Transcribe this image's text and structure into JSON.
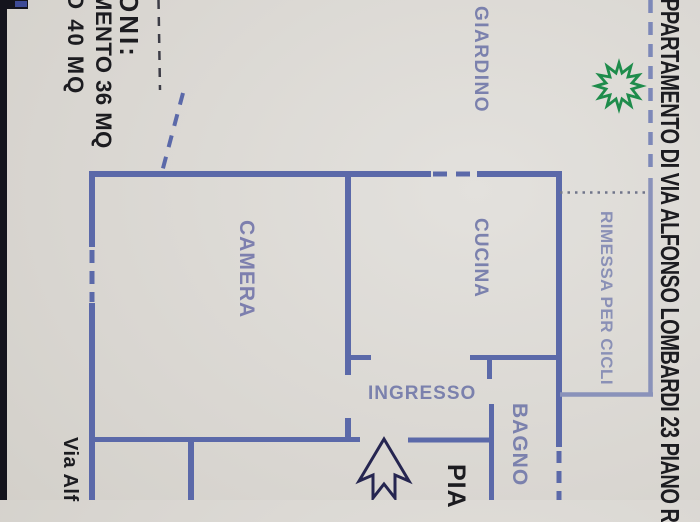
{
  "title_right": "PPARTAMENTO DI VIA ALFONSO LOMBARDI 23 PIANO R",
  "notes_top_left": {
    "line1": "ONI:",
    "line2": "MENTO 36 MQ",
    "line3": "O 40 MQ"
  },
  "street_label": "Via Alf",
  "plan_word": "PIA",
  "rooms": {
    "giardino": "GIARDINO",
    "camera": "CAMERA",
    "cucina": "CUCINA",
    "ingresso": "INGRESSO",
    "bagno": "BAGNO",
    "rimessa": "RIMESSA PER CICLI"
  },
  "symbols": {
    "tree_icon": "green starburst tree",
    "entrance_arrow_icon": "entrance direction arrow pointing up"
  },
  "colors": {
    "wall": "#5b69a9",
    "wall_light": "#8a92ba",
    "label": "#7b81ad",
    "ink": "#1c1c20",
    "garden_dash": "#7d88b8",
    "dotted": "#70758a",
    "green": "#1e8c4b",
    "arrow": "#252550",
    "paper": "#d9d6d1",
    "photo_edge": "#14141d"
  }
}
